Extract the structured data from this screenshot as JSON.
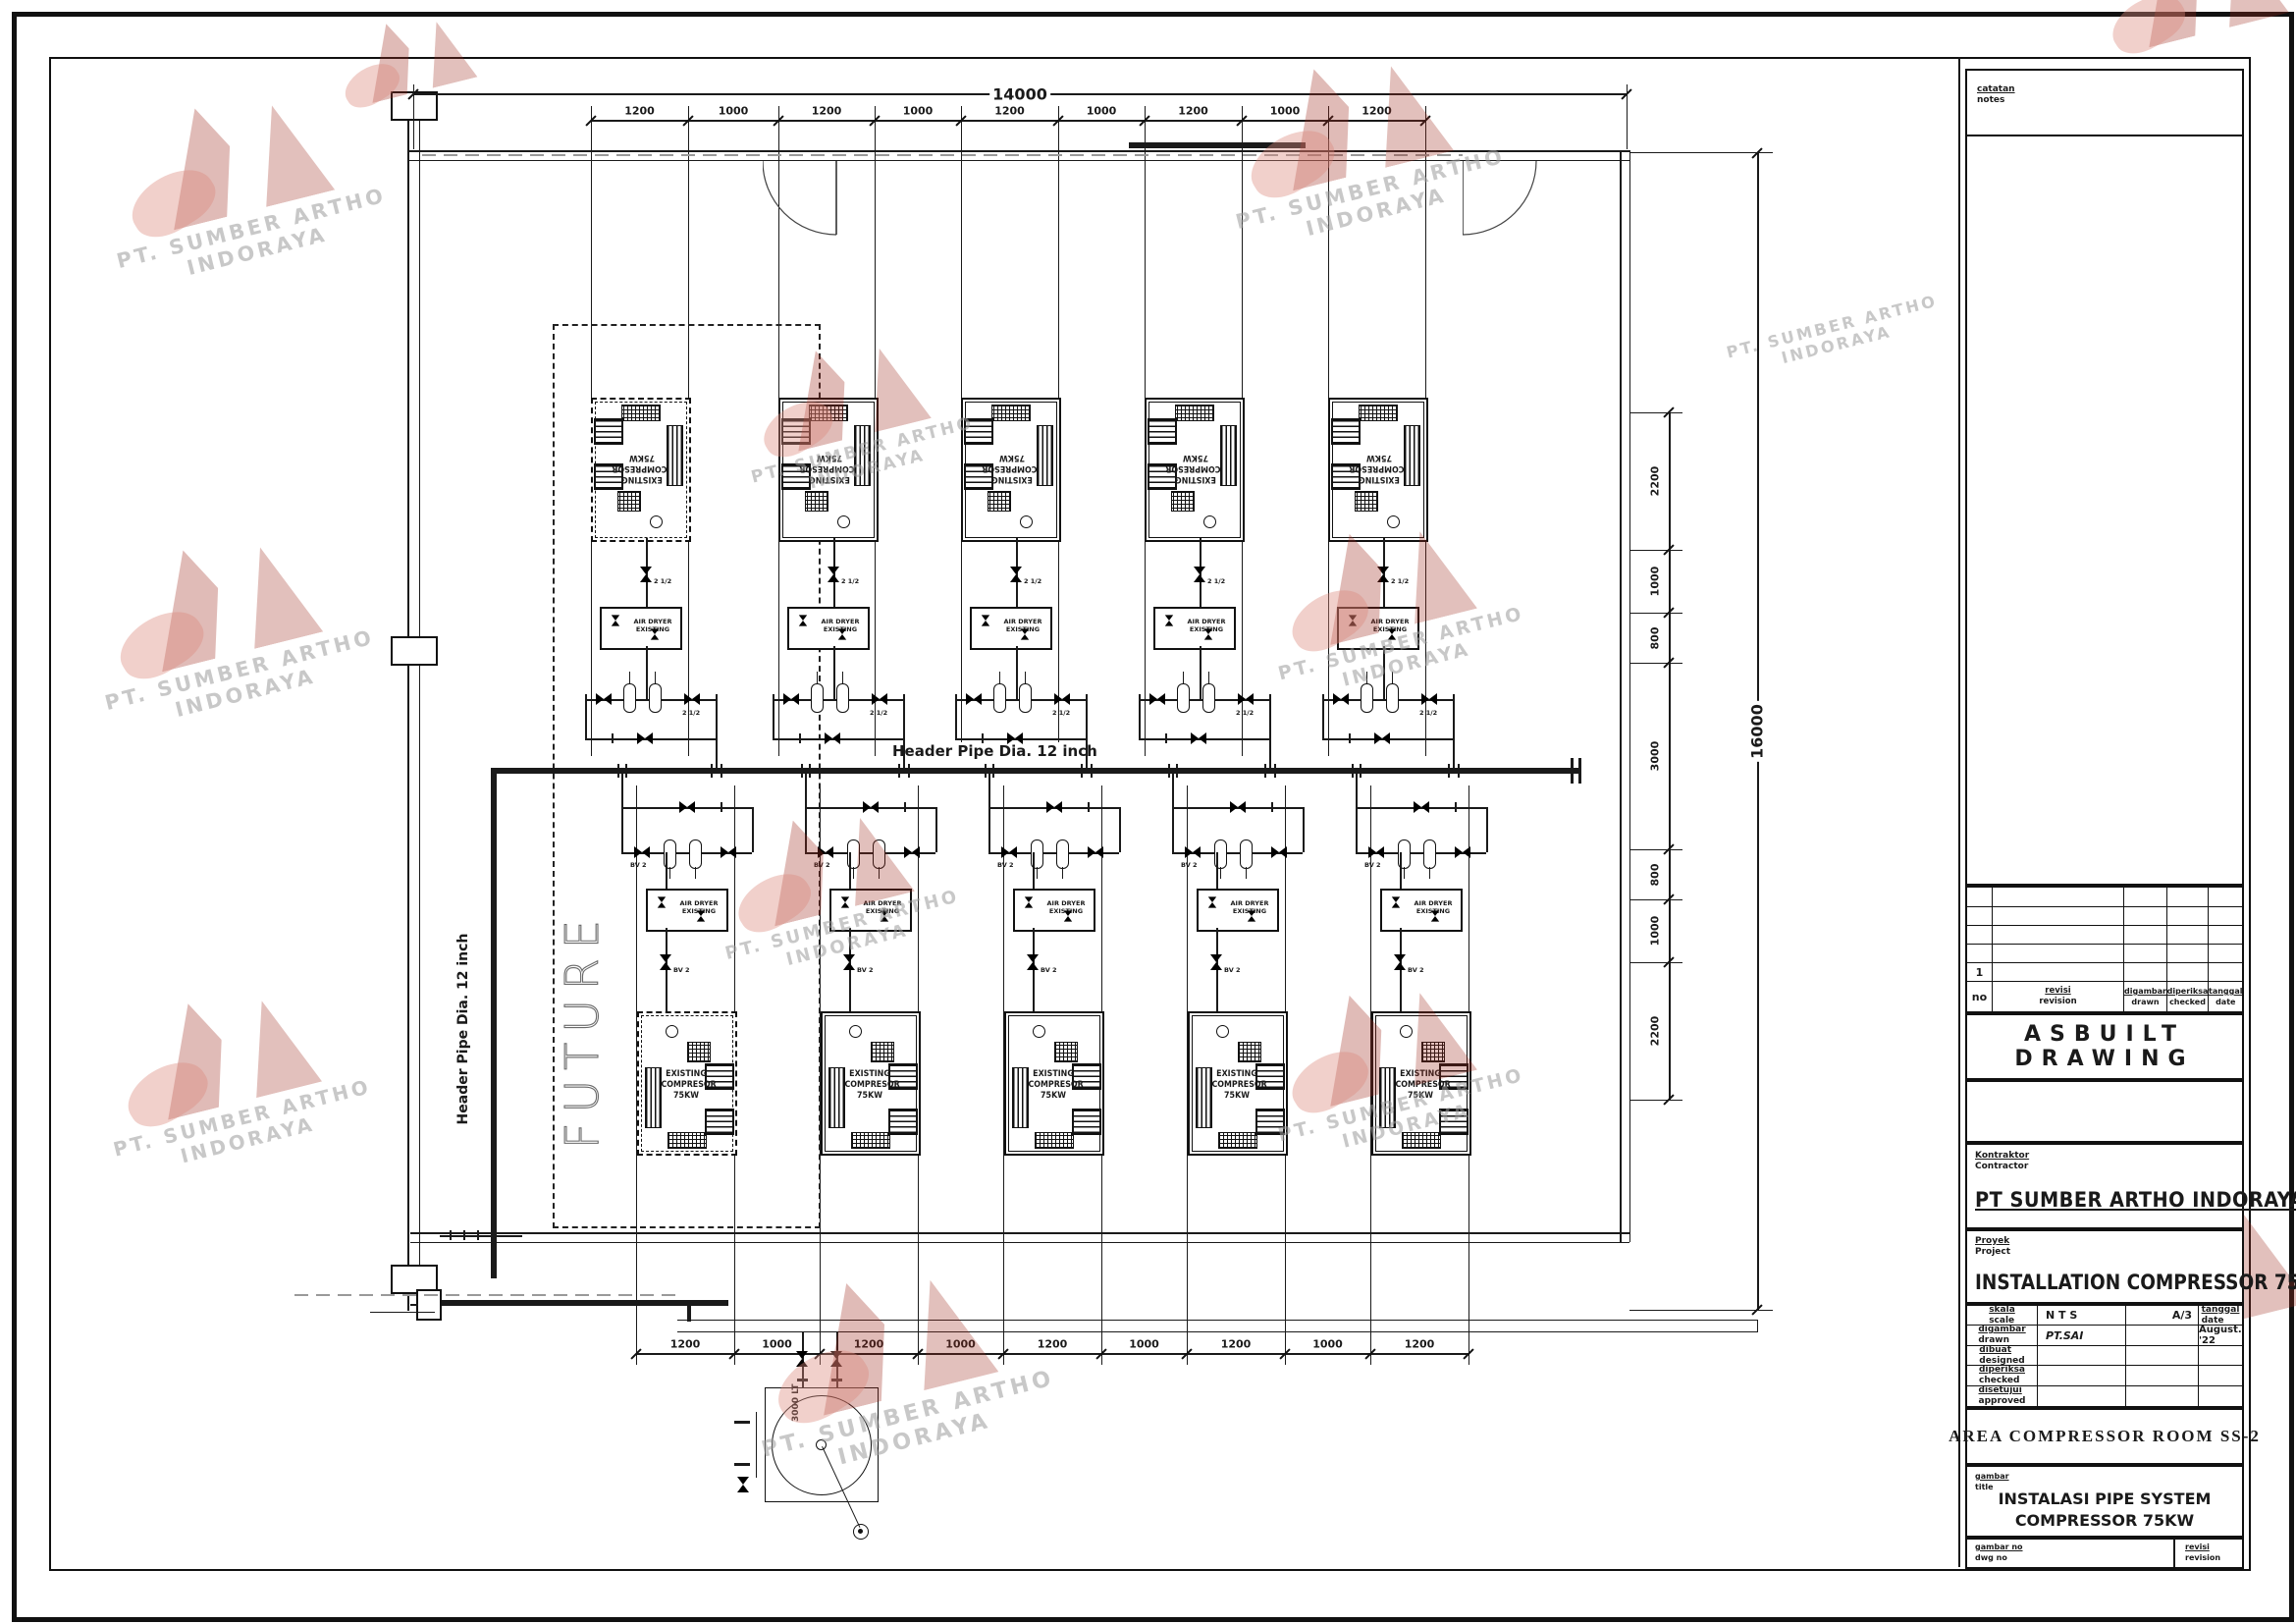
{
  "colors": {
    "ink": "#1a1a1a",
    "paper": "#ffffff",
    "watermark_red_dark": "#9e2d20",
    "watermark_red_light": "#dd8a7c",
    "watermark_gray": "#9c9c9c"
  },
  "watermark": {
    "line1": "PT. SUMBER ARTHO",
    "line2": "INDORAYA"
  },
  "plan": {
    "overall_width": "14000",
    "overall_height": "16000",
    "top_dims": [
      "1200",
      "1000",
      "1200",
      "1000",
      "1200",
      "1000",
      "1200",
      "1000",
      "1200"
    ],
    "bottom_dims": [
      "1200",
      "1000",
      "1200",
      "1000",
      "1200",
      "1000",
      "1200",
      "1000",
      "1200"
    ],
    "right_dims": [
      "2200",
      "1000",
      "800",
      "3000",
      "800",
      "1000",
      "2200"
    ],
    "header_pipe_label": "Header Pipe Dia. 12 inch",
    "left_header_pipe_label": "Header Pipe Dia. 12 inch",
    "future_label": "FUTURE",
    "compressor_lines": [
      "EXISTING",
      "COMPRESOR",
      "75KW"
    ],
    "air_dryer_lines": [
      "AIR DRYER",
      "EXISTING"
    ],
    "valve_size_label": "2 1/2",
    "bv_label": "BV 2",
    "tank_label": "3000 LT"
  },
  "title_block": {
    "notes": {
      "label_top": "catatan",
      "label_bottom": "notes"
    },
    "revision_table": {
      "no_label": "no",
      "row_no": "1",
      "col_revision": {
        "top": "revisi",
        "bottom": "revision"
      },
      "col_drawn": {
        "top": "digambar",
        "bottom": "drawn"
      },
      "col_checked": {
        "top": "diperiksa",
        "bottom": "checked"
      },
      "col_date": {
        "top": "tanggal",
        "bottom": "date"
      }
    },
    "asbuilt_title": "ASBUILT DRAWING",
    "contractor": {
      "label_top": "Kontraktor",
      "label_bottom": "Contractor",
      "name": "PT SUMBER ARTHO INDORAYA"
    },
    "project": {
      "label_top": "Proyek",
      "label_bottom": "Project",
      "name": "INSTALLATION COMPRESSOR 75KW"
    },
    "info_rows": [
      {
        "label_top": "skala",
        "label_bottom": "scale",
        "col2": "N T S",
        "col3": "A/3",
        "col4_top": "tanggal",
        "col4_bottom": "date"
      },
      {
        "label_top": "digambar",
        "label_bottom": "drawn",
        "col2": "PT.SAI",
        "col3": "",
        "col4": "August. '22"
      },
      {
        "label_top": "dibuat",
        "label_bottom": "designed",
        "col2": "",
        "col3": "",
        "col4": ""
      },
      {
        "label_top": "diperiksa",
        "label_bottom": "checked",
        "col2": "",
        "col3": "",
        "col4": ""
      },
      {
        "label_top": "disetujui",
        "label_bottom": "approved",
        "col2": "",
        "col3": "",
        "col4": ""
      }
    ],
    "area_title": "AREA COMPRESSOR ROOM SS-2",
    "drawing_title": {
      "label_top": "gambar",
      "label_bottom": "title",
      "line1": "INSTALASI PIPE SYSTEM",
      "line2": "COMPRESSOR 75KW"
    },
    "dwg_no": {
      "label_top": "gambar no",
      "label_bottom": "dwg no"
    },
    "revision_cell": {
      "label_top": "revisi",
      "label_bottom": "revision"
    }
  }
}
